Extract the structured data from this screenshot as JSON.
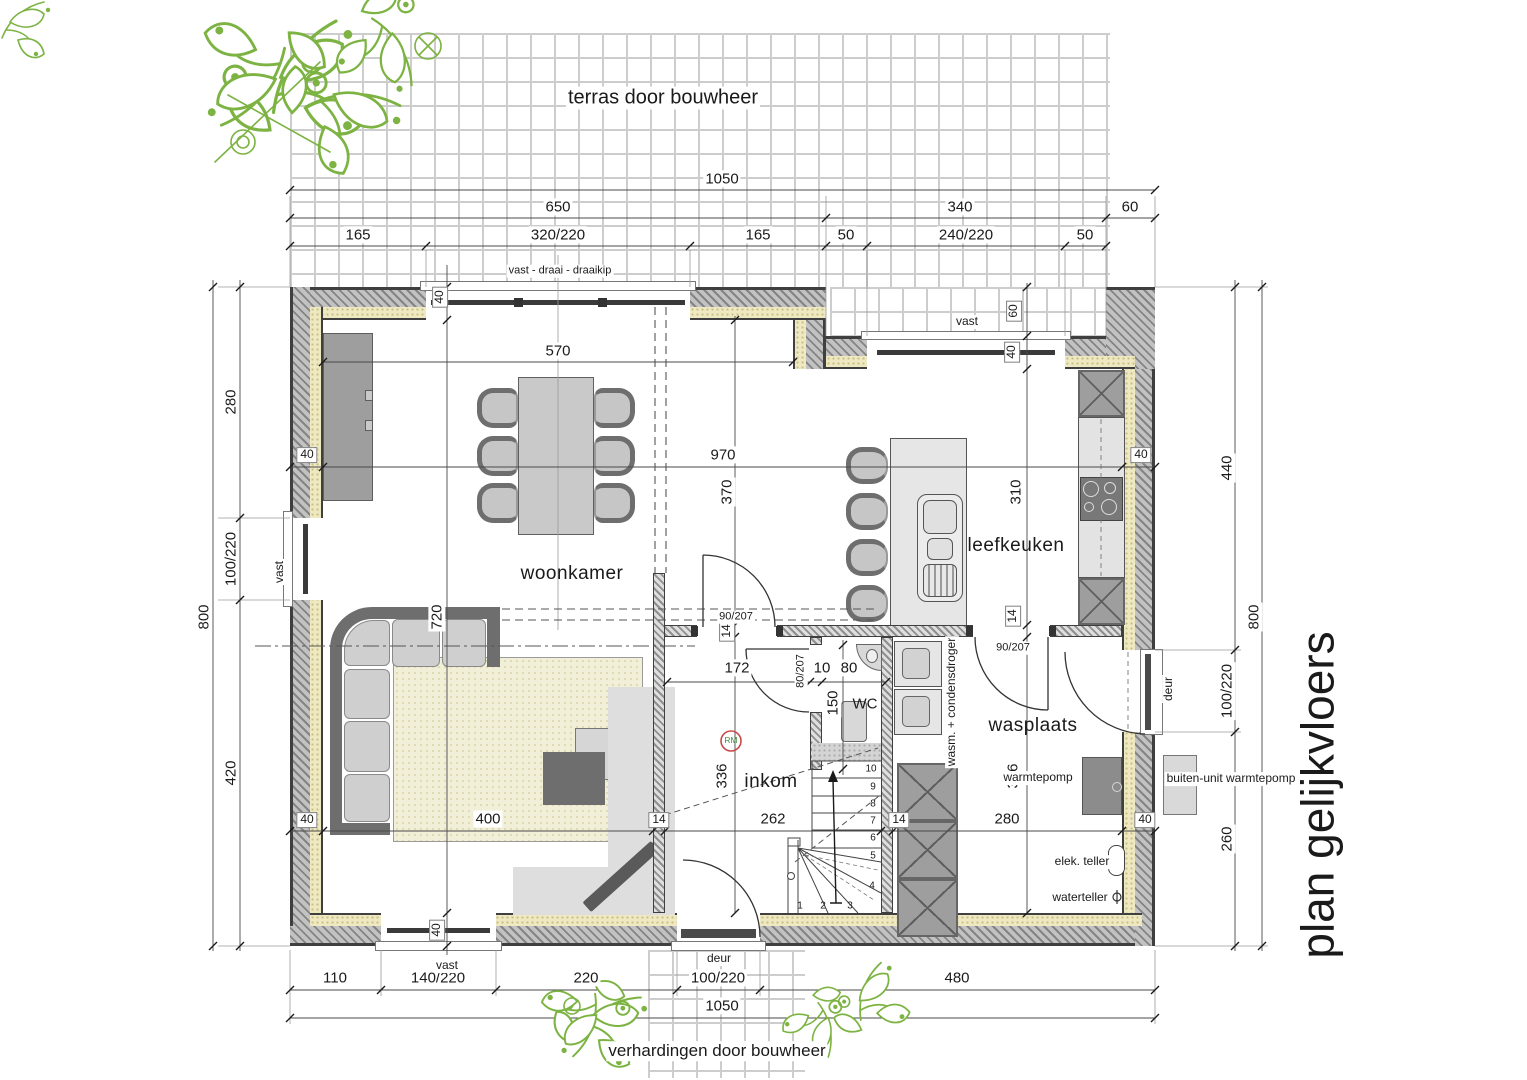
{
  "annotations": {
    "terras": "terras door bouwheer",
    "verhardingen": "verhardingen door bouwheer",
    "plan_title": "plan gelijkvloers"
  },
  "rooms": {
    "woonkamer": "woonkamer",
    "leefkeuken": "leefkeuken",
    "inkom": "inkom",
    "wasplaats": "wasplaats",
    "wc": "WC"
  },
  "openings": {
    "top_window": "vast - draai - draaikip",
    "vast": "vast",
    "deur": "deur",
    "door_90": "90/207",
    "door_80": "80/207"
  },
  "equipment": {
    "wasm": "wasm. + condensdroger",
    "warmtepomp": "warmtepomp",
    "buiten_unit": "buiten-unit warmtepomp",
    "elek_teller": "elek. teller",
    "waterteller": "waterteller",
    "rm": "RM"
  },
  "dims": {
    "d1050": "1050",
    "d650": "650",
    "d340": "340",
    "d60": "60",
    "d165": "165",
    "d320_220": "320/220",
    "d50": "50",
    "d240_220": "240/220",
    "d110": "110",
    "d140_220": "140/220",
    "d220": "220",
    "d100_220": "100/220",
    "d480": "480",
    "d800": "800",
    "d280": "280",
    "d420": "420",
    "d440": "440",
    "d260": "260",
    "d570": "570",
    "d970": "970",
    "d370": "370",
    "d310": "310",
    "d720": "720",
    "d400": "400",
    "d262": "262",
    "d172": "172",
    "d150": "150",
    "d336": "336",
    "d10": "10",
    "d80": "80",
    "d40": "40",
    "d14": "14"
  },
  "stairs": {
    "steps": [
      "1",
      "2",
      "3",
      "4",
      "5",
      "6",
      "7",
      "8",
      "9",
      "10"
    ]
  },
  "colors": {
    "wall": "#3f3f3f",
    "insulation": "#efe9c2",
    "plant": "#7cb342",
    "rm": "#c74a4a"
  }
}
